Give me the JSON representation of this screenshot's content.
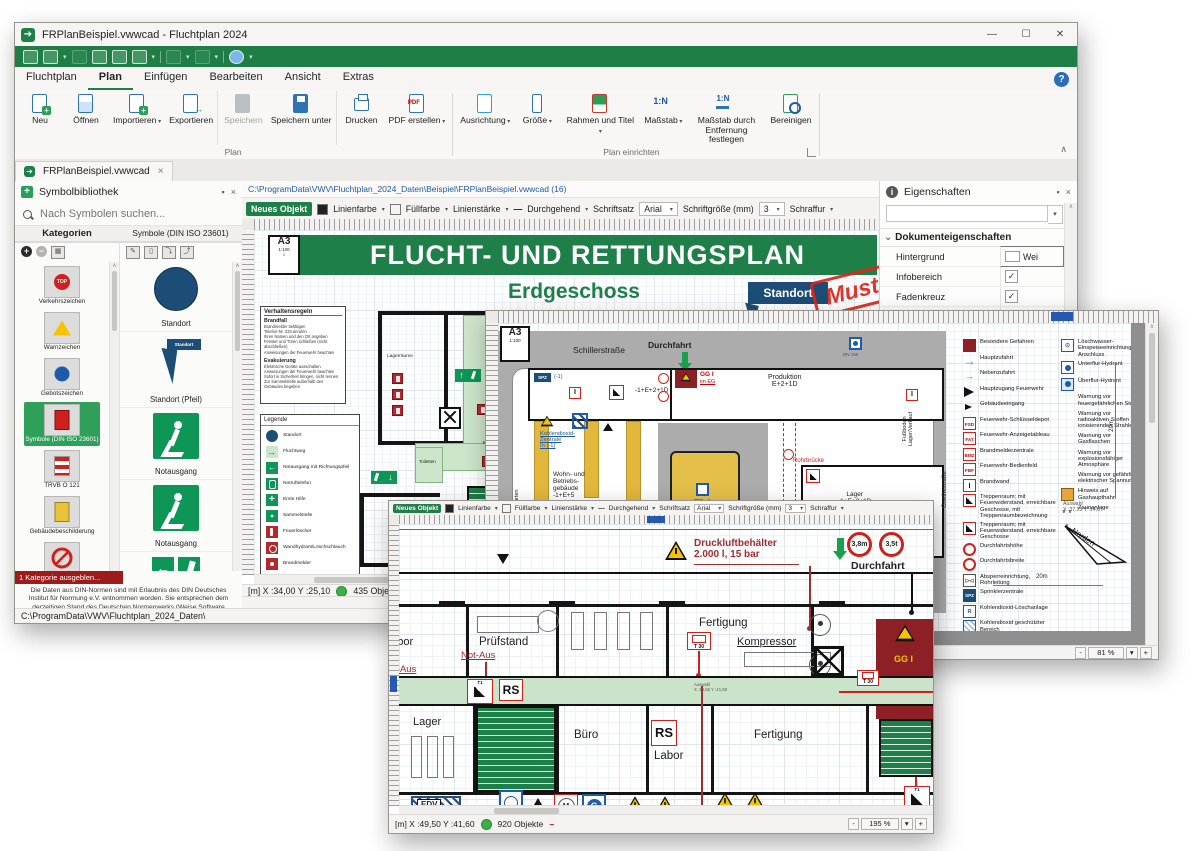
{
  "app": {
    "title": "FRPlanBeispiel.vwwcad - Fluchtplan 2024",
    "menu_tabs": [
      {
        "label": "Fluchtplan"
      },
      {
        "label": "Plan",
        "cls": "active"
      },
      {
        "label": "Einfügen"
      },
      {
        "label": "Bearbeiten"
      },
      {
        "label": "Ansicht"
      },
      {
        "label": "Extras"
      }
    ],
    "help_icon": "?",
    "ribbon": {
      "plan": {
        "label": "Plan",
        "buttons": [
          {
            "label": "Neu",
            "icon": "ic-new"
          },
          {
            "label": "Öffnen",
            "icon": "ic-open"
          },
          {
            "label": "Importieren",
            "icon": "ic-import",
            "cls": "has-caret"
          },
          {
            "label": "Exportieren",
            "icon": "ic-export",
            "cls": "sep-after"
          },
          {
            "label": "Speichern",
            "icon": "ic-save",
            "cls": "disabled"
          },
          {
            "label": "Speichern unter",
            "icon": "ic-saveas",
            "cls": "sep-after"
          },
          {
            "label": "Drucken",
            "icon": "ic-print"
          },
          {
            "label": "PDF erstellen",
            "icon": "ic-pdf",
            "cls": "has-caret"
          }
        ]
      },
      "setup": {
        "label": "Plan einrichten",
        "buttons": [
          {
            "label": "Ausrichtung",
            "icon": "ic-orient",
            "cls": "has-caret"
          },
          {
            "label": "Größe",
            "icon": "ic-size",
            "cls": "has-caret"
          },
          {
            "label": "Rahmen und Titel",
            "icon": "ic-frame",
            "cls": "has-caret"
          },
          {
            "label": "Maßstab",
            "icon": "ic-scale",
            "cls": "has-caret"
          },
          {
            "label": "Maßstab durch Entfernung festlegen",
            "icon": "ic-scaledist"
          },
          {
            "label": "Bereinigen",
            "icon": "ic-clean"
          }
        ]
      }
    },
    "doc_tab": "FRPlanBeispiel.vwwcad",
    "bottom_path": "C:\\ProgramData\\VWV\\Fluchtplan_2024_Daten\\"
  },
  "sidebar": {
    "title": "Symbolbibliothek",
    "search": "Nach Symbolen suchen...",
    "col1": "Kategorien",
    "col2": "Symbole (DIN ISO 23601)",
    "categories": [
      {
        "label": "Verkehrszeichen",
        "icon": "cat-top"
      },
      {
        "label": "Warnzeichen",
        "icon": "cat-warn"
      },
      {
        "label": "Gebotszeichen",
        "icon": "cat-gebot"
      },
      {
        "label": "Symbole (DIN ISO 23601)",
        "icon": "cat-din",
        "cls": "selected"
      },
      {
        "label": "TRVB O 121",
        "icon": "cat-trvb"
      },
      {
        "label": "Gebäudebeschilderung",
        "icon": "cat-geb"
      },
      {
        "label": "Verbotszeichen",
        "icon": "cat-verbot"
      }
    ],
    "hidden_badge": "1 Kategorie ausgeblen...",
    "disclaimer": "Die Daten aus DIN-Normen sind mit Erlaubnis des DIN Deutsches Institut für Normung e.V. entnommen worden. Sie entsprechen dem derzeitigen Stand des Deutschen Normenwerks (Weise Software GmbH).",
    "symbols": [
      {
        "label": "Standort",
        "icon": "sym-standort"
      },
      {
        "label": "Standort (Pfeil)",
        "icon": "sym-pfeil"
      },
      {
        "label": "Notausgang",
        "icon": "sym-run"
      },
      {
        "label": "Notausgang",
        "icon": "sym-run"
      },
      {
        "label": "Notausgang",
        "icon": "sym-left"
      }
    ]
  },
  "objbar": {
    "new_object": "Neues Objekt",
    "line_color": "Linienfarbe",
    "fill_color": "Füllfarbe",
    "line_width": "Linienstärke",
    "line_style": "Durchgehend",
    "font_label": "Schriftsatz",
    "font": "Arial",
    "size_label": "Schriftgröße (mm)",
    "size": "3",
    "hatch": "Schraffur"
  },
  "doc": {
    "path": "C:\\ProgramData\\VWV\\Fluchtplan_2024_Daten\\Beispiel\\FRPlanBeispiel.vwwcad (16)",
    "sheet": "A3",
    "sheet_scale": "1:100",
    "title": "FLUCHT- UND RETTUNGSPLAN",
    "subtitle": "Erdgeschoss",
    "standort": "Standort",
    "stamp": "Muster",
    "rules": {
      "title": "Verhaltensregeln",
      "s1": "Brandfall",
      "s1_lines": [
        "Brandmelder betätigen",
        "Telefon-Nr. 333 anrufen",
        "Ihren Namen und den Ort angeben",
        "Fenster und Türen schließen (nicht abschließen)",
        "Anweisungen der Feuerwehr beachten"
      ],
      "s2": "Evakuierung",
      "s2_lines": [
        "Elektrische Geräte ausschalten",
        "Anweisungen der Feuerwehr beachten",
        "Sofort in Sicherheit bringen, nicht rennen",
        "Zur Sammelstelle außerhalb des Gebäudes begeben"
      ]
    },
    "legend_title": "Legende",
    "legend": [
      {
        "label": "Standort",
        "icon": "lg-standort"
      },
      {
        "label": "Fluchtweg",
        "icon": "lg-weg"
      },
      {
        "label": "Notausgang mit Richtungspfeil",
        "icon": "lg-exit"
      },
      {
        "label": "Notruftelefon",
        "icon": "lg-tel"
      },
      {
        "label": "Erste Hilfe",
        "icon": "lg-eh"
      },
      {
        "label": "Sammelstelle",
        "icon": "lg-sammel"
      },
      {
        "label": "Feuerlöscher",
        "icon": "lg-fl"
      },
      {
        "label": "Wandhydrant/Löschschlauch",
        "icon": "lg-wh"
      },
      {
        "label": "Brandmelder",
        "icon": "lg-bm"
      }
    ],
    "rooms": {
      "lagerraeume": "Lagerräume",
      "kueche": "Küche",
      "toiletten": "Toiletten"
    },
    "status": {
      "coords": "[m] X :34,00 Y :25,10",
      "objects": "435 Objekte",
      "scale": "1: 100"
    }
  },
  "props": {
    "title": "Eigenschaften",
    "section": "Dokumenteigenschaften",
    "rows": [
      {
        "label": "Hintergrund",
        "value": "Wei",
        "type": "swatch"
      },
      {
        "label": "Infobereich",
        "type": "check"
      },
      {
        "label": "Fadenkreuz",
        "type": "check"
      },
      {
        "label": "Lineal",
        "type": "check"
      },
      {
        "label": "Maßstab ( 1 : ... )",
        "value": "100",
        "type": "text"
      },
      {
        "label": "Bauteil-Bemaßung",
        "type": "uncheck"
      },
      {
        "label": "Angabe Schriftgrößen",
        "value": "Millimeter (",
        "type": "text"
      },
      {
        "label": "Dynamische Hilfslinien",
        "type": "check"
      },
      {
        "label": "Hilfslinien",
        "type": "check"
      }
    ]
  },
  "fire": {
    "sheet": "A3",
    "sheet_scale": "1:100",
    "street_top": "Schillerstraße",
    "durchfahrt": "Durchfahrt",
    "dn150": "DN 150",
    "dn150b": "DN 150",
    "spz": "SPZ",
    "spz_lvl": "(-1)",
    "b1": "-1+E+2+1D",
    "gg": "GG I",
    "gg2": "im EG",
    "produktion": "Produktion\nE+2+1D",
    "fussboden": "Fußboden\nLager/Verkauf",
    "co2": "Kohlendioxid-\nZentrale\nIn (-1)",
    "wohn": "Wohn- und\nBetriebs-\ngebäude\n-1+E+5",
    "rohr": "Rohrbrücke",
    "lager": "Lager\n-1+E+2+1D",
    "pond": "200m²",
    "kindergarten": "Kindergarten",
    "goethe": "Goethestraße",
    "legend_left": [
      {
        "label": "Besondere Gefahren",
        "icon": "fl-danger"
      },
      {
        "label": "Hauptzufahrt",
        "icon": "fl-arrow-big"
      },
      {
        "label": "Nebenzufahrt",
        "icon": "fl-arrow-small"
      },
      {
        "label": "Hauptzugang Feuerwehr",
        "icon": "fl-tri-big"
      },
      {
        "label": "Gebäudeeingang",
        "icon": "fl-tri-small"
      },
      {
        "label": "Feuerwehr-Schlüsseldepot",
        "icon": "fl-fsd",
        "tag": "FSD"
      },
      {
        "label": "Feuerwehr-Anzeigetableau",
        "icon": "fl-fat",
        "tag": "FAT"
      },
      {
        "label": "Brandmelderzentrale",
        "icon": "fl-bmz",
        "tag": "BMZ"
      },
      {
        "label": "Feuerwehr-Bedienfeld",
        "icon": "fl-fbf",
        "tag": "FBF"
      },
      {
        "label": "Brandwand",
        "icon": "fl-wall",
        "tag": "I"
      },
      {
        "label": "Treppenraum; mit Feuerwiderstand, erreichbare Geschosse, mit Treppenraumbezeichnung",
        "icon": "fl-stair1"
      },
      {
        "label": "Treppenraum; mit Feuerwiderstand, erreichbare Geschosse",
        "icon": "fl-stair2"
      },
      {
        "label": "Durchfahrtshöhe",
        "icon": "fl-height"
      },
      {
        "label": "Durchfahrtsbreite",
        "icon": "fl-width"
      },
      {
        "label": "Absperreinrichtung, Rohrleitung",
        "icon": "fl-valve"
      },
      {
        "label": "Sprinklerzentrale",
        "icon": "fl-spz",
        "tag": "SPZ"
      },
      {
        "label": "Kohlendioxid-Löschanlage",
        "icon": "fl-co2"
      },
      {
        "label": "Kohlendioxid geschützter Bereich",
        "icon": "fl-co2area"
      }
    ],
    "legend_right": [
      {
        "label": "Löschwasser-Einspeiseeinrichtung, B-Anschluss",
        "icon": "fr-feed"
      },
      {
        "label": "Unterflur-Hydrant",
        "icon": "fr-under"
      },
      {
        "label": "Überflur-Hydrant",
        "icon": "fr-over"
      },
      {
        "label": "Warnung vor feuergefährlichen Stoffen",
        "icon": "fr-warn"
      },
      {
        "label": "Warnung vor radioaktiven Stoffen oder ionisierenden Strahlen",
        "icon": "fr-warn"
      },
      {
        "label": "Warnung vor Gasflaschen",
        "icon": "fr-warn"
      },
      {
        "label": "Warnung vor explosionsfähiger Atmosphäre",
        "icon": "fr-warn"
      },
      {
        "label": "Warnung vor gefährlicher elektrischer Spannung",
        "icon": "fr-warn"
      },
      {
        "label": "Hinweis auf Gashaupthahn",
        "icon": "fr-gas-main"
      },
      {
        "label": "Zaunanlage",
        "icon": "fr-fence"
      }
    ],
    "auswahl": "Auswahl",
    "auswahl_xy": "X :37,13 Y :14,67",
    "dim_v": "20m",
    "dim_h": "20m",
    "north": "Norden",
    "zoom": "81 %"
  },
  "detail": {
    "druckluft": "Druckluftbehälter\n2.000 l, 15 bar",
    "sign_h": "3,8m",
    "sign_w": "3,5t",
    "durchfahrt": "Durchfahrt",
    "labor1": "Labor",
    "notaus": "Not-Aus",
    "notaus2": "Not-Aus",
    "pruefstand": "Prüfstand",
    "fertigung1": "Fertigung",
    "kompressor": "Kompressor",
    "t30": "T 30",
    "t30b": "T 30",
    "t1": "T1",
    "t1b": "T1",
    "rs": "RS",
    "rsb": "RS",
    "lager": "Lager",
    "buero": "Büro",
    "labor2": "Labor",
    "fertigung2": "Fertigung",
    "gg": "GG I",
    "edv": "EDV",
    "sprinkler": "Sprinkleranlage",
    "geringe": "geringe\nMengen",
    "propan": "1 Flasche Propan 30 kg",
    "auswahl": "Auswahl",
    "auswahl_xy": "X :49,55 Y :41,59",
    "status": {
      "coords": "[m] X :49,50 Y :41,60",
      "objects": "920 Objekte",
      "zoom": "195 %"
    }
  },
  "zoomctl": {
    "minus": "-",
    "plus": "+"
  }
}
